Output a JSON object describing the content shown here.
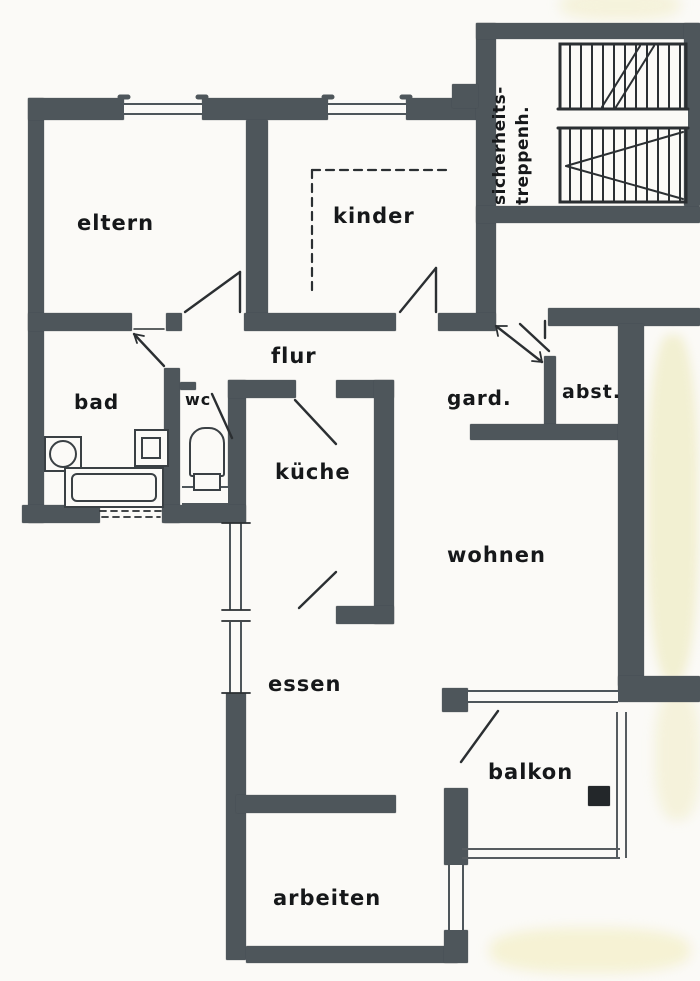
{
  "document": {
    "type": "apartment floor plan (scanned drawing)"
  },
  "rooms": [
    {
      "id": "eltern",
      "label": "eltern"
    },
    {
      "id": "kinder",
      "label": "kinder"
    },
    {
      "id": "flur",
      "label": "flur"
    },
    {
      "id": "bad",
      "label": "bad"
    },
    {
      "id": "wc",
      "label": "wc"
    },
    {
      "id": "kueche",
      "label": "küche"
    },
    {
      "id": "gard",
      "label": "gard."
    },
    {
      "id": "abst",
      "label": "abst."
    },
    {
      "id": "wohnen",
      "label": "wohnen"
    },
    {
      "id": "essen",
      "label": "essen"
    },
    {
      "id": "balkon",
      "label": "balkon"
    },
    {
      "id": "arbeiten",
      "label": "arbeiten"
    }
  ],
  "stairwell": {
    "line1": "sicherheits-",
    "line2": "treppenh."
  },
  "colors": {
    "paper": "#fbfaf7",
    "wall": "#4e565b",
    "ink": "#26292c",
    "stain": "#ece7b8"
  }
}
